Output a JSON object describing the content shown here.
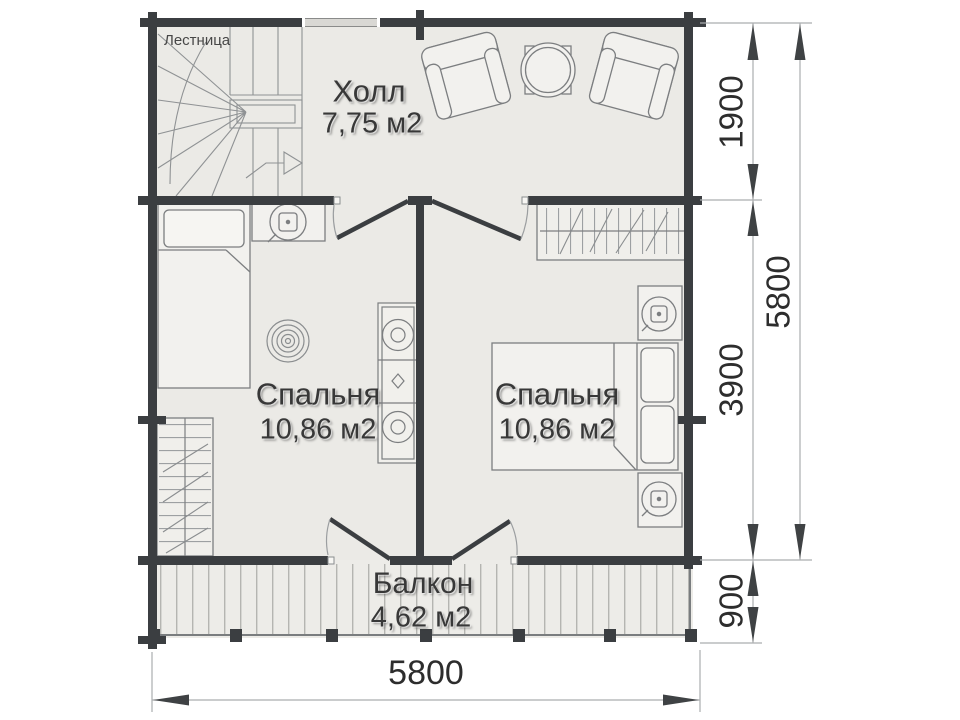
{
  "rooms": {
    "hall": {
      "name": "Холл",
      "area": "7,75 м2"
    },
    "bedroom_left": {
      "name": "Спальня",
      "area": "10,86 м2"
    },
    "bedroom_right": {
      "name": "Спальня",
      "area": "10,86 м2"
    },
    "balcony": {
      "name": "Балкон",
      "area": "4,62 м2"
    }
  },
  "labels": {
    "staircase": "Лестница"
  },
  "dimensions": {
    "right_upper": "1900",
    "right_lower": "3900",
    "right_total": "5800",
    "balcony_depth": "900",
    "bottom_width": "5800"
  },
  "colors": {
    "wall": "#3b3e41",
    "floor": "#ebeae6",
    "balcony_floor": "#edece8",
    "furniture_stroke": "#7c7e80",
    "dimension_text": "#2d2d2d",
    "label_text": "#383838",
    "background": "#ffffff"
  }
}
